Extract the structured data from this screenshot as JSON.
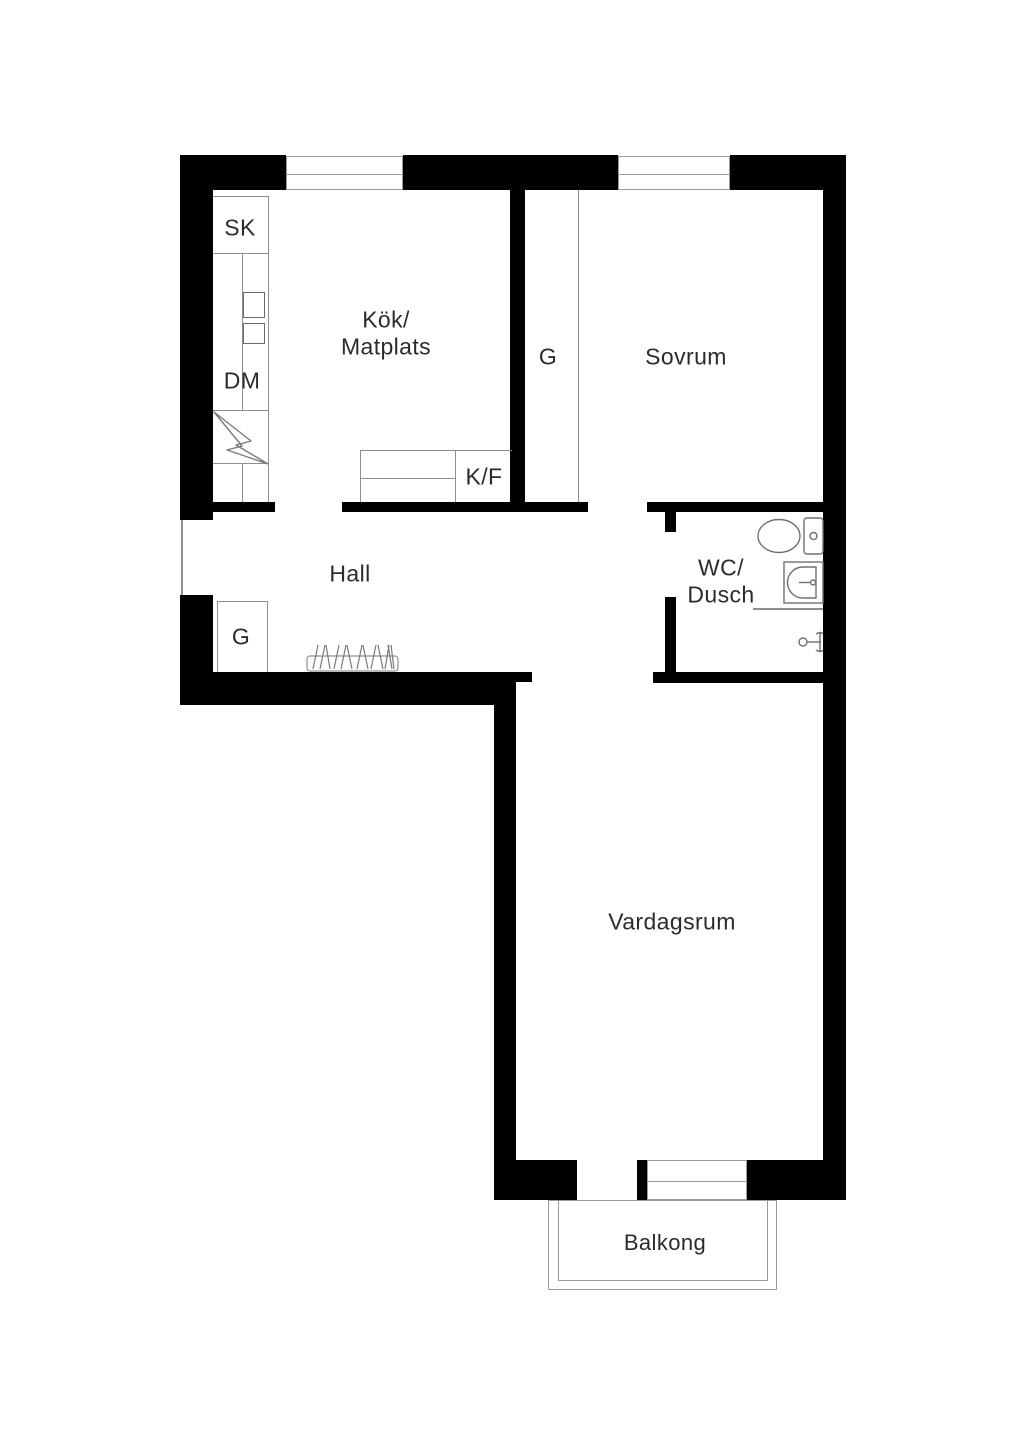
{
  "rooms": {
    "kitchen": {
      "line1": "Kök/",
      "line2": "Matplats"
    },
    "bedroom": {
      "label": "Sovrum"
    },
    "hall": {
      "label": "Hall"
    },
    "wc": {
      "line1": "WC/",
      "line2": "Dusch"
    },
    "living_room": {
      "label": "Vardagsrum"
    },
    "balcony": {
      "label": "Balkong"
    }
  },
  "closets": {
    "bedroom_wardrobe": {
      "label": "G"
    },
    "hall_wardrobe": {
      "label": "G"
    }
  },
  "kitchen_fixtures": {
    "tall_cabinet": {
      "label": "SK"
    },
    "dishwasher": {
      "label": "DM"
    },
    "fridge_freezer": {
      "label": "K/F"
    }
  },
  "icons": {
    "toilet": "toilet-icon",
    "sink": "sink-icon",
    "shower_mixer": "shower-mixer-icon",
    "electrical": "lightning-icon",
    "coat_rack": "coat-rack-icon",
    "hob_boxes": "hob-icon",
    "windows": "window-symbol"
  },
  "colors": {
    "wall": "#000000",
    "thin_line": "#8f8f8f",
    "fixture_stroke": "#707070",
    "text": "#2b2b2b",
    "background": "#ffffff"
  }
}
